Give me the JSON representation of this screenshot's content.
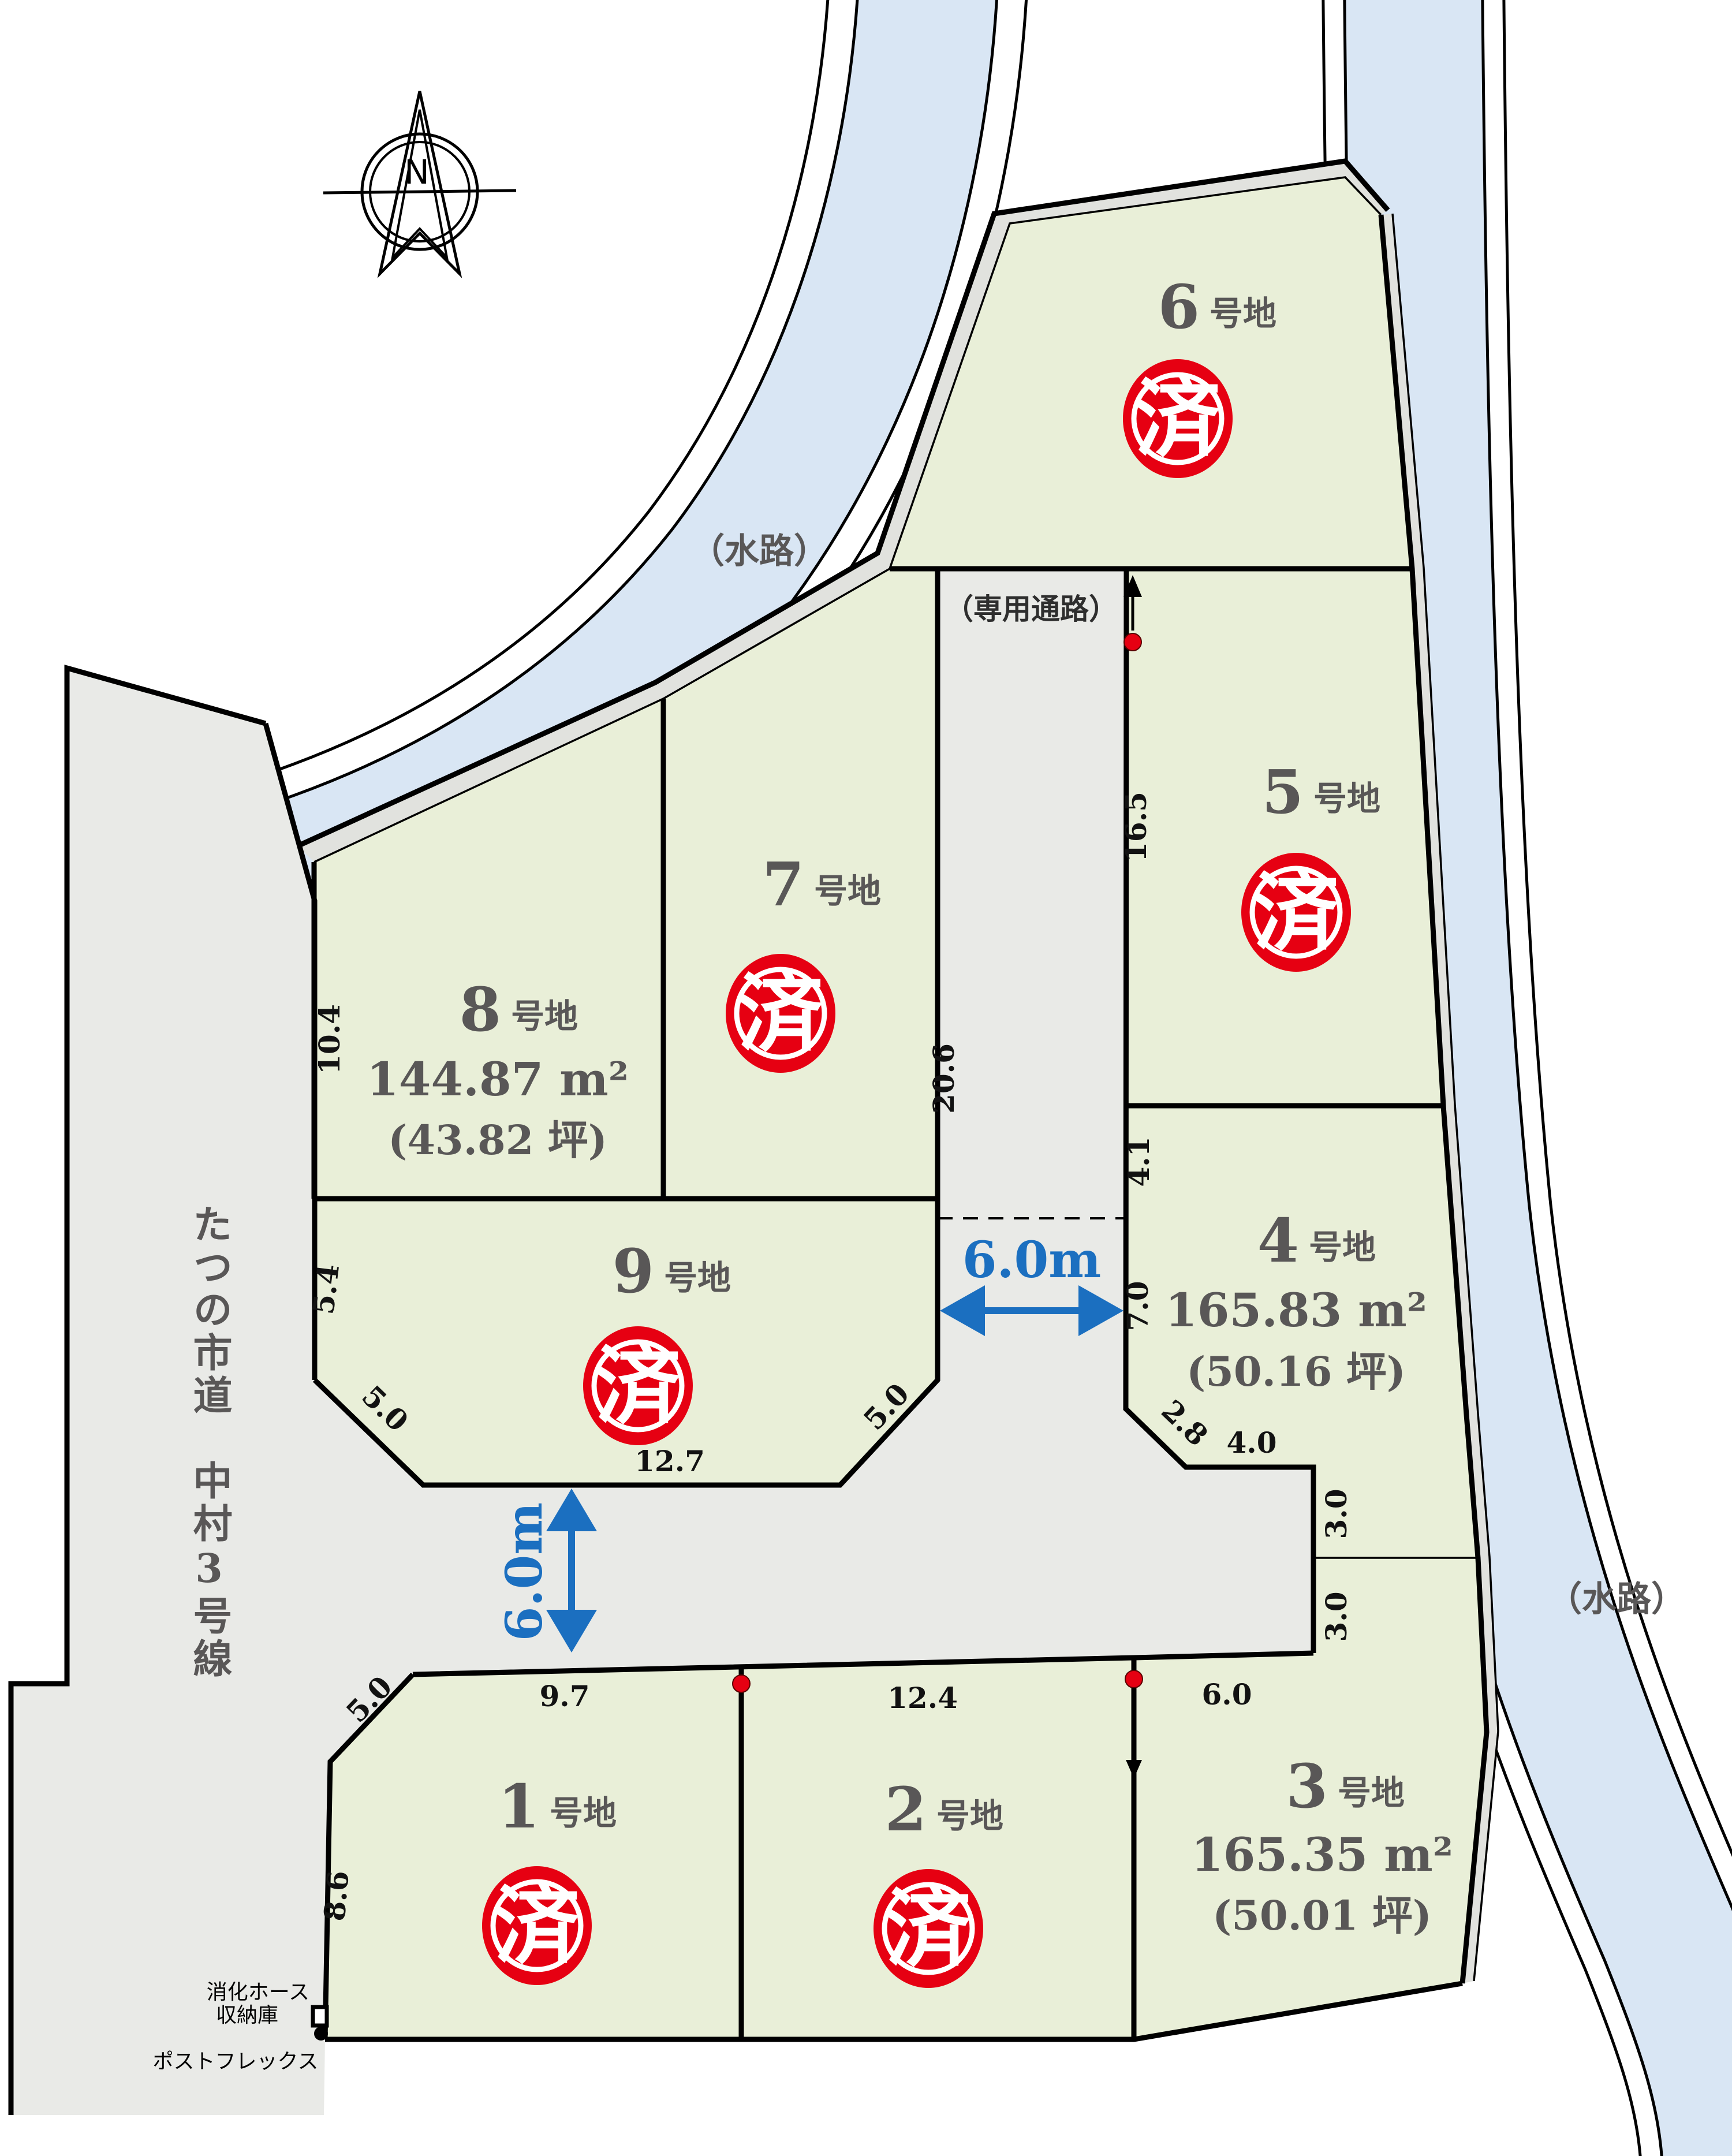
{
  "colors": {
    "lot_green": "#e9efd8",
    "road_gray": "#e9eae7",
    "bank_gray": "#e1e2de",
    "water_blue": "#d9e6f4",
    "stamp_red": "#e60012",
    "dim_blue": "#1b6fc0",
    "label_gray": "#595757"
  },
  "compass": {
    "north_label": "N"
  },
  "labels": {
    "waterway_left": "（水路）",
    "waterway_right": "（水路）",
    "corridor": "（専用通路）",
    "road_name": "たつの市道　中村3号線",
    "hose_box_line1": "消化ホース",
    "hose_box_line2": "収納庫",
    "post_flex": "ポストフレックス"
  },
  "road_dims": {
    "horizontal": "6.0m",
    "vertical": "6.0m"
  },
  "stamp_text": "済",
  "lots": [
    {
      "num": "1",
      "suffix": "号地",
      "sold": true
    },
    {
      "num": "2",
      "suffix": "号地",
      "sold": true
    },
    {
      "num": "3",
      "suffix": "号地",
      "area": "165.35 m²",
      "tsubo": "(50.01 坪)",
      "sold": false
    },
    {
      "num": "4",
      "suffix": "号地",
      "area": "165.83 m²",
      "tsubo": "(50.16 坪)",
      "sold": false
    },
    {
      "num": "5",
      "suffix": "号地",
      "sold": true
    },
    {
      "num": "6",
      "suffix": "号地",
      "sold": true
    },
    {
      "num": "7",
      "suffix": "号地",
      "sold": true
    },
    {
      "num": "8",
      "suffix": "号地",
      "area": "144.87 m²",
      "tsubo": "(43.82 坪)",
      "sold": false
    },
    {
      "num": "9",
      "suffix": "号地",
      "sold": true
    }
  ],
  "dims": [
    "10.4",
    "5.4",
    "5.0",
    "12.7",
    "5.0",
    "20.6",
    "16.5",
    "4.1",
    "7.0",
    "2.8",
    "4.0",
    "3.0",
    "3.0",
    "9.7",
    "12.4",
    "6.0",
    "5.0",
    "8.6"
  ]
}
